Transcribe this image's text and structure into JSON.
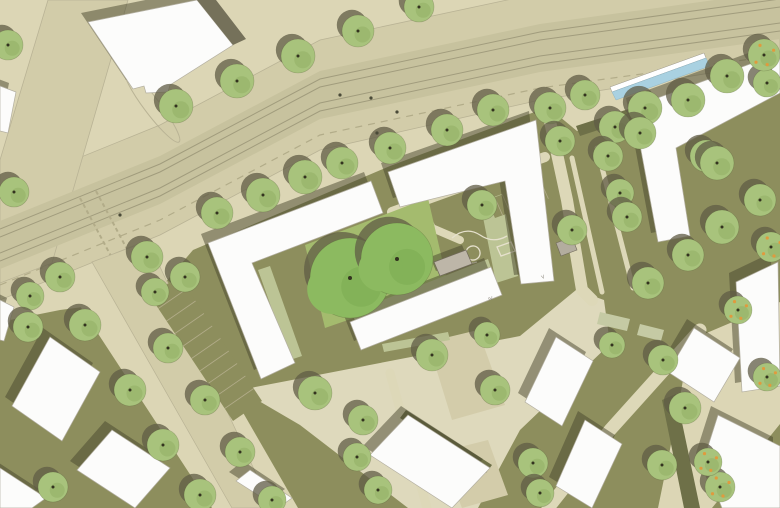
{
  "canvas": {
    "w": 780,
    "h": 508
  },
  "palette": {
    "base": "#dcd6b5",
    "road": "#d2cca9",
    "road_edge": "#b9b395",
    "tram": "#c7c29e",
    "track": "#a19c7d",
    "dash": "#b2ac89",
    "olive": "#8d8e5d",
    "olive_dark": "#6e7048",
    "path": "#ddd8b8",
    "plaza": "#ded9bc",
    "pit": "#d3ccaa",
    "sage": "#bcc495",
    "sage_rect": "#c5caa4",
    "lawn": "#a4bb6e",
    "tree": "#a8c37c",
    "tree_dark": "#8fae61",
    "big_tree": "#8cba60",
    "big_tree_dark": "#7aa950",
    "tree_shadow": "rgba(96,92,70,0.75)",
    "bld_shadow": "rgba(72,70,46,0.5)",
    "roof": "#fcfcfb",
    "roof_edge": "#b3afa1",
    "annex": "#75715a",
    "pavilion": "#bdb6a8",
    "shed": "#b3ad9f",
    "water": "#a9d1e1",
    "white": "#ffffff",
    "ink": "#4a4a38",
    "doodle": "#e6e1cd",
    "fruit": "#e09a3e",
    "label": "#8a867a",
    "trunk": "#33331f",
    "canopy_edge": "rgba(80,90,50,0.35)"
  },
  "ground": {
    "roadway": [
      [
        0,
        190
      ],
      [
        160,
        125
      ],
      [
        320,
        40
      ],
      [
        540,
        -7
      ],
      [
        780,
        -40
      ],
      [
        780,
        62
      ],
      [
        540,
        100
      ],
      [
        320,
        150
      ],
      [
        160,
        235
      ],
      [
        0,
        300
      ]
    ],
    "left_street": [
      [
        48,
        0
      ],
      [
        128,
        0
      ],
      [
        52,
        263
      ],
      [
        0,
        283
      ],
      [
        0,
        160
      ]
    ],
    "tram_band": [
      [
        0,
        221
      ],
      [
        160,
        156
      ],
      [
        320,
        71
      ],
      [
        540,
        24
      ],
      [
        780,
        -9
      ],
      [
        780,
        39
      ],
      [
        540,
        72
      ],
      [
        320,
        119
      ],
      [
        160,
        204
      ],
      [
        0,
        269
      ]
    ],
    "track_centerline": [
      [
        0,
        245
      ],
      [
        160,
        180
      ],
      [
        320,
        95
      ],
      [
        540,
        48
      ],
      [
        780,
        15
      ]
    ],
    "track_offsets": [
      -16,
      -8,
      8,
      16
    ],
    "lane_dash": [
      [
        0,
        285
      ],
      [
        160,
        220
      ],
      [
        320,
        135
      ],
      [
        540,
        88
      ],
      [
        780,
        55
      ]
    ],
    "olive_zone": [
      [
        152,
        298
      ],
      [
        193,
        250
      ],
      [
        390,
        166
      ],
      [
        548,
        107
      ],
      [
        577,
        131
      ],
      [
        780,
        66
      ],
      [
        780,
        508
      ],
      [
        0,
        508
      ],
      [
        0,
        322
      ],
      [
        60,
        310
      ]
    ],
    "south_street_sidewalk": [
      [
        78,
        303
      ],
      [
        162,
        272
      ],
      [
        298,
        508
      ],
      [
        212,
        508
      ]
    ],
    "south_street_road": [
      [
        92,
        262
      ],
      [
        148,
        241
      ],
      [
        272,
        508
      ],
      [
        232,
        508
      ]
    ],
    "right_street": [
      [
        690,
        340
      ],
      [
        780,
        302
      ],
      [
        780,
        424
      ],
      [
        712,
        508
      ],
      [
        658,
        508
      ],
      [
        676,
        420
      ]
    ],
    "pale_zone": [
      [
        240,
        390
      ],
      [
        520,
        336
      ],
      [
        576,
        290
      ],
      [
        604,
        300
      ],
      [
        610,
        344
      ],
      [
        520,
        430
      ],
      [
        478,
        508
      ],
      [
        408,
        508
      ],
      [
        300,
        425
      ]
    ],
    "tree_pits": [
      [
        [
          428,
          342
        ],
        [
          478,
          330
        ],
        [
          505,
          405
        ],
        [
          452,
          420
        ]
      ],
      [
        [
          440,
          452
        ],
        [
          488,
          440
        ],
        [
          508,
          495
        ],
        [
          462,
          508
        ]
      ]
    ],
    "island": {
      "cx": 152,
      "cy": 106,
      "rx": 45,
      "ry": 8,
      "rot": 53
    },
    "crosswalk": [
      [
        [
          80,
          198
        ],
        [
          112,
          258
        ]
      ],
      [
        [
          96,
          191
        ],
        [
          128,
          251
        ]
      ]
    ]
  },
  "paths": [
    {
      "pts": [
        [
          392,
          212
        ],
        [
          545,
          157
        ]
      ],
      "w": 10
    },
    {
      "pts": [
        [
          412,
          168
        ],
        [
          420,
          205
        ],
        [
          432,
          228
        ],
        [
          460,
          240
        ]
      ],
      "w": 8
    },
    {
      "pts": [
        [
          548,
          112
        ],
        [
          567,
          200
        ],
        [
          582,
          290
        ],
        [
          592,
          300
        ]
      ],
      "w": 12
    },
    {
      "pts": [
        [
          548,
          508
        ],
        [
          610,
          430
        ],
        [
          700,
          330
        ]
      ],
      "w": 13
    },
    {
      "pts": [
        [
          390,
          373
        ],
        [
          427,
          508
        ]
      ],
      "w": 9
    },
    {
      "pts": [
        [
          572,
          158
        ],
        [
          602,
          292
        ]
      ],
      "w": 5
    },
    {
      "pts": [
        [
          597,
          148
        ],
        [
          633,
          288
        ]
      ],
      "w": 5
    }
  ],
  "hedges": [
    [
      [
        576,
        126
      ],
      [
        780,
        60
      ],
      [
        780,
        70
      ],
      [
        580,
        136
      ]
    ],
    [
      [
        662,
        400
      ],
      [
        676,
        394
      ],
      [
        700,
        508
      ],
      [
        684,
        508
      ]
    ],
    [
      [
        406,
        410
      ],
      [
        492,
        465
      ],
      [
        486,
        473
      ],
      [
        400,
        418
      ]
    ]
  ],
  "lawn": [
    [
      305,
      245
    ],
    [
      428,
      198
    ],
    [
      448,
      285
    ],
    [
      325,
      328
    ]
  ],
  "garden_strips": [
    [
      [
        480,
        202
      ],
      [
        502,
        194
      ],
      [
        518,
        276
      ],
      [
        496,
        283
      ]
    ],
    [
      [
        352,
        312
      ],
      [
        488,
        259
      ],
      [
        491,
        268
      ],
      [
        355,
        321
      ]
    ],
    [
      [
        258,
        270
      ],
      [
        270,
        266
      ],
      [
        302,
        356
      ],
      [
        290,
        360
      ]
    ],
    [
      [
        382,
        344
      ],
      [
        448,
        332
      ],
      [
        450,
        340
      ],
      [
        384,
        352
      ]
    ]
  ],
  "sage_rects": [
    [
      [
        600,
        312
      ],
      [
        630,
        319
      ],
      [
        627,
        331
      ],
      [
        597,
        324
      ]
    ],
    [
      [
        640,
        324
      ],
      [
        664,
        330
      ],
      [
        661,
        341
      ],
      [
        637,
        335
      ]
    ]
  ],
  "parking": [
    {
      "quad": [
        [
          150,
          296
        ],
        [
          233,
          421
        ],
        [
          262,
          401
        ],
        [
          179,
          276
        ]
      ],
      "count": 10
    },
    {
      "quad": [
        [
          487,
          200
        ],
        [
          548,
          178
        ],
        [
          556,
          196
        ],
        [
          495,
          218
        ]
      ],
      "count": 8
    }
  ],
  "doodles": [
    "M452,238 q14,-12 28,-3 q13,9 27,1",
    "M466,252 a7,7 0 1 0 14,2 a7,7 0 1 0 -14,-2",
    "M497,247 l14,-5 4,9 -14,5 z",
    "M455,258 q10,8 22,4"
  ],
  "buildings": [
    {
      "name": "block-northwest",
      "pts": [
        [
          88,
          22
        ],
        [
          197,
          0
        ],
        [
          233,
          45
        ],
        [
          170,
          85
        ],
        [
          168,
          92
        ],
        [
          146,
          93
        ],
        [
          144,
          86
        ],
        [
          133,
          89
        ]
      ]
    },
    {
      "name": "block-north-annex",
      "pts": [
        [
          197,
          0
        ],
        [
          233,
          45
        ],
        [
          246,
          39
        ],
        [
          216,
          0
        ]
      ],
      "dark": true
    },
    {
      "name": "perimeter-west-wing",
      "pts": [
        [
          208,
          243
        ],
        [
          371,
          181
        ],
        [
          383,
          213
        ],
        [
          252,
          263
        ],
        [
          295,
          363
        ],
        [
          261,
          379
        ]
      ]
    },
    {
      "name": "perimeter-north-wing",
      "pts": [
        [
          388,
          172
        ],
        [
          536,
          120
        ],
        [
          554,
          281
        ],
        [
          521,
          284
        ],
        [
          505,
          181
        ],
        [
          400,
          207
        ]
      ]
    },
    {
      "name": "courtyard-slab",
      "pts": [
        [
          350,
          322
        ],
        [
          491,
          267
        ],
        [
          502,
          295
        ],
        [
          361,
          350
        ]
      ]
    },
    {
      "name": "block-northeast",
      "pts": [
        [
          633,
          107
        ],
        [
          780,
          53
        ],
        [
          780,
          93
        ],
        [
          676,
          148
        ],
        [
          690,
          236
        ],
        [
          658,
          242
        ]
      ]
    },
    {
      "name": "block-east",
      "pts": [
        [
          736,
          282
        ],
        [
          778,
          262
        ],
        [
          780,
          386
        ],
        [
          742,
          392
        ]
      ]
    },
    {
      "name": "row-southwest-1",
      "pts": [
        [
          50,
          337
        ],
        [
          100,
          372
        ],
        [
          62,
          441
        ],
        [
          12,
          406
        ]
      ]
    },
    {
      "name": "row-southwest-2",
      "pts": [
        [
          112,
          430
        ],
        [
          170,
          468
        ],
        [
          135,
          508
        ],
        [
          77,
          470
        ]
      ]
    },
    {
      "name": "row-southwest-3",
      "pts": [
        [
          0,
          468
        ],
        [
          46,
          498
        ],
        [
          32,
          508
        ],
        [
          0,
          508
        ]
      ]
    },
    {
      "name": "row-south-1",
      "pts": [
        [
          250,
          470
        ],
        [
          292,
          498
        ],
        [
          278,
          508
        ],
        [
          236,
          481
        ]
      ]
    },
    {
      "name": "row-south-2",
      "pts": [
        [
          408,
          415
        ],
        [
          490,
          468
        ],
        [
          452,
          508
        ],
        [
          370,
          455
        ]
      ]
    },
    {
      "name": "row-southeast-1",
      "pts": [
        [
          556,
          337
        ],
        [
          593,
          361
        ],
        [
          562,
          426
        ],
        [
          525,
          402
        ]
      ]
    },
    {
      "name": "row-southeast-2",
      "pts": [
        [
          585,
          420
        ],
        [
          622,
          444
        ],
        [
          592,
          508
        ],
        [
          556,
          486
        ]
      ]
    },
    {
      "name": "row-southeast-3",
      "pts": [
        [
          694,
          328
        ],
        [
          740,
          358
        ],
        [
          714,
          402
        ],
        [
          668,
          372
        ]
      ]
    },
    {
      "name": "row-southeast-4",
      "pts": [
        [
          718,
          415
        ],
        [
          780,
          446
        ],
        [
          780,
          508
        ],
        [
          722,
          508
        ],
        [
          703,
          462
        ]
      ]
    },
    {
      "name": "edge-west-1",
      "pts": [
        [
          0,
          86
        ],
        [
          16,
          92
        ],
        [
          8,
          133
        ],
        [
          0,
          131
        ]
      ]
    },
    {
      "name": "edge-west-2",
      "pts": [
        [
          0,
          300
        ],
        [
          14,
          307
        ],
        [
          4,
          341
        ],
        [
          0,
          340
        ]
      ]
    }
  ],
  "structures": {
    "pavilion": [
      [
        434,
        262
      ],
      [
        466,
        250
      ],
      [
        472,
        264
      ],
      [
        440,
        276
      ]
    ],
    "shed": [
      [
        556,
        243
      ],
      [
        572,
        237
      ],
      [
        577,
        250
      ],
      [
        561,
        256
      ]
    ],
    "canopy_glass": [
      [
        612,
        92
      ],
      [
        706,
        58
      ],
      [
        710,
        66
      ],
      [
        616,
        100
      ]
    ],
    "canopy_edge": [
      [
        610,
        87
      ],
      [
        704,
        53
      ],
      [
        706,
        58
      ],
      [
        612,
        92
      ]
    ]
  },
  "trees": {
    "standard": [
      [
        176,
        106,
        17
      ],
      [
        237,
        81,
        17
      ],
      [
        298,
        56,
        17
      ],
      [
        358,
        31,
        16
      ],
      [
        419,
        7,
        15
      ],
      [
        8,
        45,
        15
      ],
      [
        14,
        192,
        15
      ],
      [
        60,
        277,
        15
      ],
      [
        30,
        296,
        14
      ],
      [
        147,
        257,
        16
      ],
      [
        185,
        277,
        15
      ],
      [
        155,
        292,
        14
      ],
      [
        217,
        213,
        16
      ],
      [
        263,
        195,
        17
      ],
      [
        305,
        177,
        17
      ],
      [
        342,
        163,
        16
      ],
      [
        390,
        148,
        16
      ],
      [
        447,
        130,
        16
      ],
      [
        493,
        110,
        16
      ],
      [
        550,
        108,
        16
      ],
      [
        585,
        95,
        15
      ],
      [
        615,
        127,
        16
      ],
      [
        645,
        108,
        17
      ],
      [
        688,
        100,
        17
      ],
      [
        727,
        76,
        17
      ],
      [
        767,
        83,
        14
      ],
      [
        608,
        156,
        15
      ],
      [
        560,
        141,
        15
      ],
      [
        706,
        156,
        16
      ],
      [
        640,
        133,
        16
      ],
      [
        620,
        193,
        14
      ],
      [
        627,
        217,
        15
      ],
      [
        717,
        163,
        17
      ],
      [
        722,
        227,
        17
      ],
      [
        760,
        200,
        16
      ],
      [
        688,
        255,
        16
      ],
      [
        648,
        283,
        16
      ],
      [
        482,
        205,
        15
      ],
      [
        572,
        230,
        15
      ],
      [
        85,
        325,
        16
      ],
      [
        130,
        390,
        16
      ],
      [
        163,
        445,
        16
      ],
      [
        200,
        495,
        16
      ],
      [
        28,
        327,
        15
      ],
      [
        53,
        487,
        15
      ],
      [
        168,
        348,
        15
      ],
      [
        205,
        400,
        15
      ],
      [
        240,
        452,
        15
      ],
      [
        272,
        500,
        14
      ],
      [
        315,
        393,
        17
      ],
      [
        432,
        355,
        16
      ],
      [
        363,
        420,
        15
      ],
      [
        357,
        457,
        14
      ],
      [
        378,
        490,
        14
      ],
      [
        487,
        335,
        13
      ],
      [
        495,
        390,
        15
      ],
      [
        533,
        463,
        15
      ],
      [
        540,
        493,
        14
      ],
      [
        663,
        360,
        15
      ],
      [
        685,
        408,
        16
      ],
      [
        662,
        465,
        15
      ],
      [
        612,
        345,
        13
      ]
    ],
    "big": [
      [
        350,
        278,
        40
      ],
      [
        397,
        259,
        36
      ]
    ],
    "fruit": [
      [
        764,
        55,
        16
      ],
      [
        771,
        247,
        15
      ],
      [
        720,
        487,
        15
      ],
      [
        767,
        377,
        14
      ],
      [
        738,
        310,
        14
      ],
      [
        708,
        462,
        14
      ]
    ]
  },
  "figures": [
    [
      371,
      98
    ],
    [
      397,
      112
    ],
    [
      377,
      133
    ],
    [
      120,
      215
    ],
    [
      340,
      95
    ]
  ],
  "annotations": [
    {
      "text": "IV",
      "x": 489,
      "y": 301,
      "rot": -21
    },
    {
      "text": "V",
      "x": 542,
      "y": 279,
      "rot": -21
    }
  ]
}
